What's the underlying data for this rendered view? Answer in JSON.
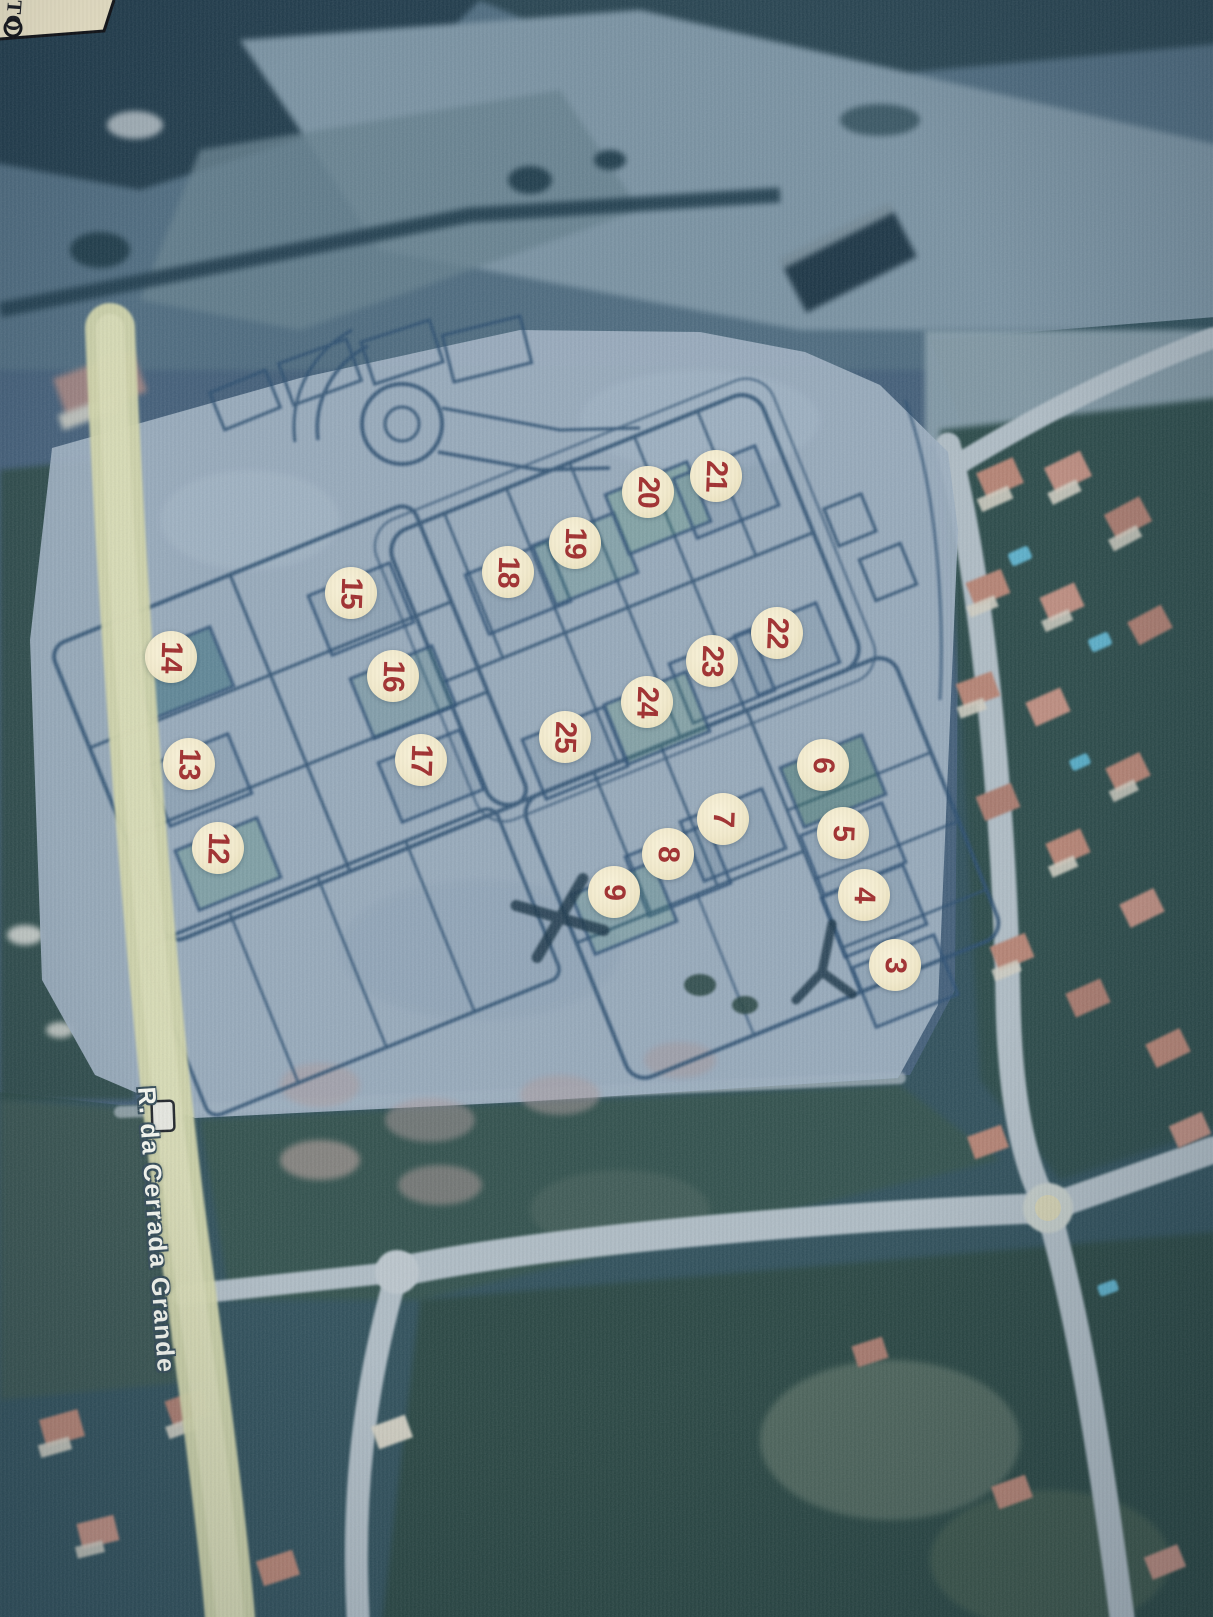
{
  "corner_note": {
    "text": "TO"
  },
  "street_label": {
    "text": "R. da Cerrada Grande"
  },
  "lot_markers": {
    "fill": "#f2ebd0",
    "number_color": "#a23434",
    "items": [
      {
        "label": "3",
        "x": 895,
        "y": 965,
        "glow": true
      },
      {
        "label": "4",
        "x": 864,
        "y": 895,
        "glow": true
      },
      {
        "label": "5",
        "x": 843,
        "y": 833,
        "glow": false
      },
      {
        "label": "6",
        "x": 823,
        "y": 765,
        "glow": true
      },
      {
        "label": "7",
        "x": 723,
        "y": 819,
        "glow": false
      },
      {
        "label": "8",
        "x": 668,
        "y": 854,
        "glow": false
      },
      {
        "label": "9",
        "x": 614,
        "y": 892,
        "glow": true
      },
      {
        "label": "12",
        "x": 218,
        "y": 848,
        "glow": true
      },
      {
        "label": "13",
        "x": 189,
        "y": 764,
        "glow": false
      },
      {
        "label": "14",
        "x": 171,
        "y": 657,
        "glow": true
      },
      {
        "label": "15",
        "x": 351,
        "y": 593,
        "glow": false
      },
      {
        "label": "16",
        "x": 393,
        "y": 676,
        "glow": true
      },
      {
        "label": "17",
        "x": 421,
        "y": 760,
        "glow": true
      },
      {
        "label": "18",
        "x": 508,
        "y": 572,
        "glow": true
      },
      {
        "label": "19",
        "x": 575,
        "y": 543,
        "glow": true
      },
      {
        "label": "20",
        "x": 648,
        "y": 492,
        "glow": true
      },
      {
        "label": "21",
        "x": 716,
        "y": 476,
        "glow": true
      },
      {
        "label": "22",
        "x": 777,
        "y": 633,
        "glow": false
      },
      {
        "label": "23",
        "x": 712,
        "y": 661,
        "glow": true
      },
      {
        "label": "24",
        "x": 647,
        "y": 702,
        "glow": true
      },
      {
        "label": "25",
        "x": 565,
        "y": 737,
        "glow": true
      }
    ]
  },
  "palette": {
    "plan_overlay": "#a3b4c4",
    "plan_line": "#2b4e6f",
    "road_yellow": "#d8dbac",
    "satellite_road": "#b6c2c9",
    "satellite_dark": "#30505a",
    "vegetation_dark": "#2b4a47",
    "roof_salmon": "#bd8674",
    "pool_blue": "#5fb5cf",
    "paper_cream": "#efe7ca"
  }
}
